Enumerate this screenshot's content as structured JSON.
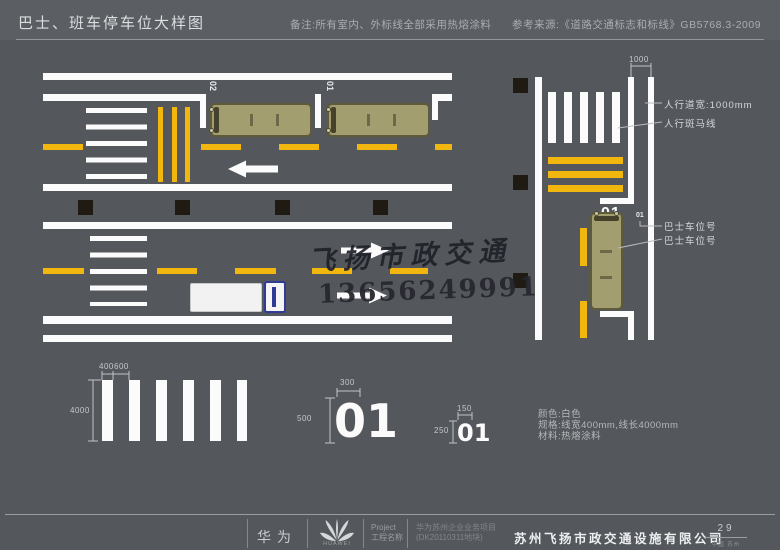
{
  "header": {
    "title": "巴士、班车停车位大样图",
    "note": "备注:所有室内、外标线全部采用热熔涂料",
    "reference": "参考来源:《道路交通标志和标线》GB5768.3-2009"
  },
  "plan_view": {
    "bay_label_1": "02",
    "bay_label_2": "01"
  },
  "side_view": {
    "dim_sidewalk": "1000",
    "bay_number": "01",
    "bay_number_small": "01",
    "anno_sidewalk_width": "人行道宽:1000mm",
    "anno_zebra": "人行斑马线",
    "anno_bay_no_1": "巴士车位号",
    "anno_bay_no_2": "巴士车位号"
  },
  "details": {
    "zebra": {
      "dim_bar_width": "400",
      "dim_gap": "600",
      "dim_length": "4000"
    },
    "number_large": {
      "value": "01",
      "dim_width": "300",
      "dim_height": "500"
    },
    "number_small": {
      "value": "01",
      "dim_width": "150",
      "dim_height": "250"
    },
    "notes_color": "颜色:白色",
    "notes_spec": "规格:线宽400mm,线长4000mm",
    "notes_material": "材料:热熔涂料"
  },
  "watermark": {
    "name": "飞扬市政交通",
    "phone": "13656249991"
  },
  "footer": {
    "brand": "华为",
    "logo_text": "HUAWEI",
    "project_label_line1": "Project",
    "project_label_line2": "工程名称",
    "project_value_line1": "华为苏州企业业务项目",
    "project_value_line2": "(DK20110311地块)",
    "company": "苏州飞扬市政交通设施有限公司",
    "page_number": "29",
    "location": "中国 苏州"
  },
  "colors": {
    "background": "#54585c",
    "line_white": "#fbfbfb",
    "marking_yellow": "#f2b70e",
    "bus_body": "#a39e6f",
    "truck_blue": "#303b96"
  }
}
